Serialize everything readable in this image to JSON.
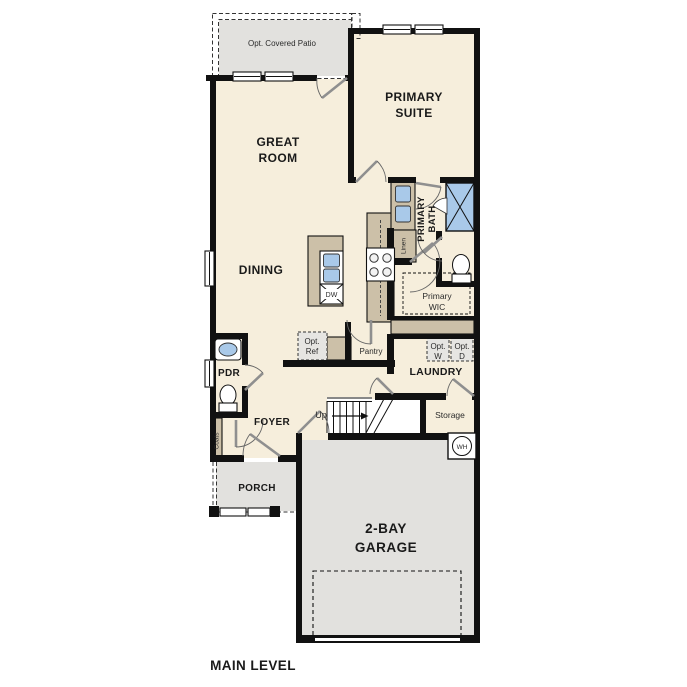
{
  "caption": "MAIN LEVEL",
  "rooms": {
    "patio": {
      "label": "Opt. Covered Patio"
    },
    "great_room": {
      "line1": "GREAT",
      "line2": "ROOM"
    },
    "primary_suite": {
      "line1": "PRIMARY",
      "line2": "SUITE"
    },
    "dining": {
      "label": "DINING"
    },
    "primary_bath": {
      "line1": "PRIMARY",
      "line2": "BATH"
    },
    "linen": {
      "label": "Linen"
    },
    "primary_wic": {
      "line1": "Primary",
      "line2": "WIC"
    },
    "pantry": {
      "label": "Pantry"
    },
    "laundry": {
      "label": "LAUNDRY"
    },
    "pdr": {
      "label": "PDR"
    },
    "coats": {
      "label": "Coats"
    },
    "foyer": {
      "label": "FOYER"
    },
    "storage": {
      "label": "Storage"
    },
    "porch": {
      "label": "PORCH"
    },
    "garage": {
      "line1": "2-BAY",
      "line2": "GARAGE"
    }
  },
  "fixtures": {
    "opt_ref": {
      "line1": "Opt.",
      "line2": "Ref"
    },
    "opt_washer": {
      "line1": "Opt.",
      "line2": "W"
    },
    "opt_dryer": {
      "line1": "Opt.",
      "line2": "D"
    },
    "dishwasher": {
      "label": "DW"
    },
    "water_heater": {
      "label": "WH"
    },
    "stairs": {
      "label": "Up"
    }
  },
  "colors": {
    "wall": "#111111",
    "interior_floor": "#f6eedc",
    "exterior_concrete": "#e2e1de",
    "cabinetry": "#ccc0a8",
    "plumbing_fixture_blue": "#a9c9e9",
    "door_swing": "#8f8f8f",
    "label_text": "#1a1a1a"
  }
}
